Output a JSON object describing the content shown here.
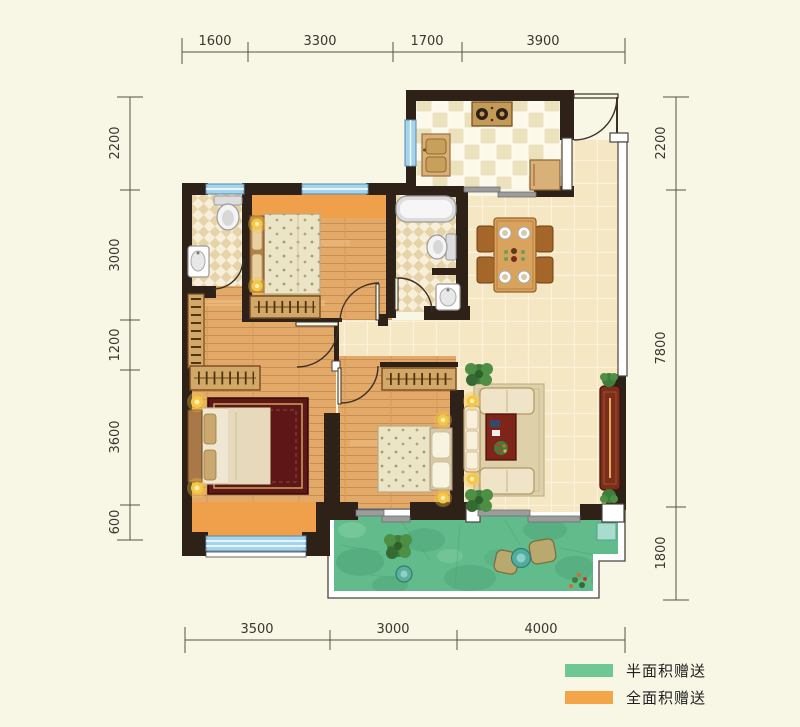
{
  "dimensions": {
    "top": [
      "1600",
      "3300",
      "1700",
      "3900"
    ],
    "left": [
      "2200",
      "3000",
      "1200",
      "3600",
      "600"
    ],
    "right": [
      "2200",
      "7800",
      "1800"
    ],
    "bottom": [
      "3500",
      "3000",
      "4000"
    ]
  },
  "legend": {
    "items": [
      {
        "label": "半面积赠送",
        "color": "#6fc793",
        "swatch_style": "background:#6fc793"
      },
      {
        "label": "全面积赠送",
        "color": "#f4a54a",
        "swatch_style": "background:#f4a54a"
      }
    ]
  },
  "palette": {
    "background": "#f8f6e4",
    "wall": "#2e2218",
    "wood_floor": "#e2a968",
    "tile_floor": "#f5e6c4",
    "kitchen_tile": "#fcf8ea",
    "bath_tile": "#e6d3a8",
    "balcony_green": "#62bb8b",
    "bay_orange": "#f09f4a",
    "window_blue": "#a2d4ee"
  }
}
